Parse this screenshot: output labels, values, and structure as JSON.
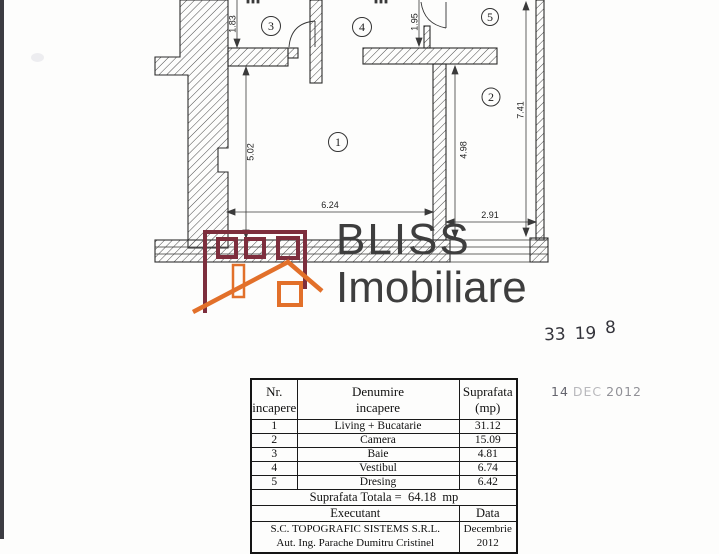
{
  "logo": {
    "line1": "BLISS",
    "line2": "Imobiliare",
    "maroon": "#7d2e3d",
    "orange": "#e2702a",
    "text_color": "#3e3e3e"
  },
  "plan": {
    "room_numbers": [
      "1",
      "2",
      "3",
      "4",
      "5"
    ],
    "dimensions": [
      "1.83",
      "1.95",
      "5.02",
      "4.98",
      "6.24",
      "2.91",
      "7.41"
    ]
  },
  "stamps": {
    "number_value": "33198",
    "number_parts": [
      "33",
      "19",
      "8"
    ],
    "date_parts": [
      "14",
      "DEC",
      "2012"
    ]
  },
  "table": {
    "headers": {
      "nr": [
        "Nr.",
        "incapere"
      ],
      "denumire": [
        "Denumire",
        "incapere"
      ],
      "suprafata": [
        "Suprafata",
        "(mp)"
      ]
    },
    "rows": [
      {
        "nr": "1",
        "name": "Living + Bucatarie",
        "area": "31.12"
      },
      {
        "nr": "2",
        "name": "Camera",
        "area": "15.09"
      },
      {
        "nr": "3",
        "name": "Baie",
        "area": "4.81"
      },
      {
        "nr": "4",
        "name": "Vestibul",
        "area": "6.74"
      },
      {
        "nr": "5",
        "name": "Dresing",
        "area": "6.42"
      }
    ],
    "total_label": "Suprafata Totala =",
    "total_value": "64.18",
    "total_unit": "mp",
    "executant_label": "Executant",
    "data_label": "Data",
    "executant_line1": "S.C. TOPOGRAFIC SISTEMS S.R.L.",
    "executant_line2": "Aut. Ing. Parache Dumitru Cristinel",
    "date_value": "Decembrie 2012"
  }
}
